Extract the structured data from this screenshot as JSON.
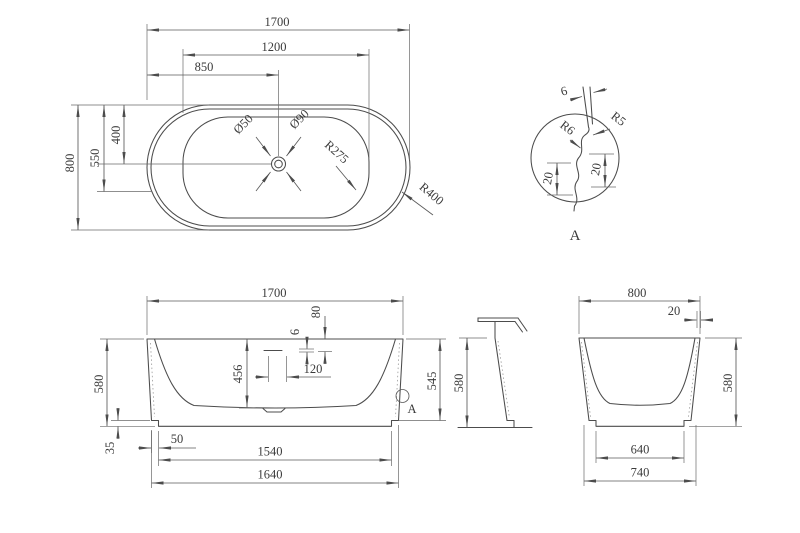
{
  "views": {
    "plan": {
      "d_1700": "1700",
      "d_1200": "1200",
      "d_850": "850",
      "d_800": "800",
      "d_550": "550",
      "d_400": "400",
      "d_o50": "Ø50",
      "d_o90": "Ø90",
      "d_r275": "R275",
      "d_r400": "R400"
    },
    "detail_a": {
      "label": "A",
      "d_6": "6",
      "d_r5": "R5",
      "d_r6": "R6",
      "d_20_left": "20",
      "d_20_right": "20"
    },
    "front": {
      "d_1700": "1700",
      "d_580": "580",
      "d_545": "545",
      "d_456": "456",
      "d_6": "6",
      "d_80": "80",
      "d_120": "120",
      "d_35": "35",
      "d_50": "50",
      "d_1540": "1540",
      "d_1640": "1640",
      "detail_ref": "A"
    },
    "section": {
      "d_580": "580"
    },
    "end": {
      "d_800": "800",
      "d_20": "20",
      "d_580": "580",
      "d_640": "640",
      "d_740": "740"
    }
  }
}
